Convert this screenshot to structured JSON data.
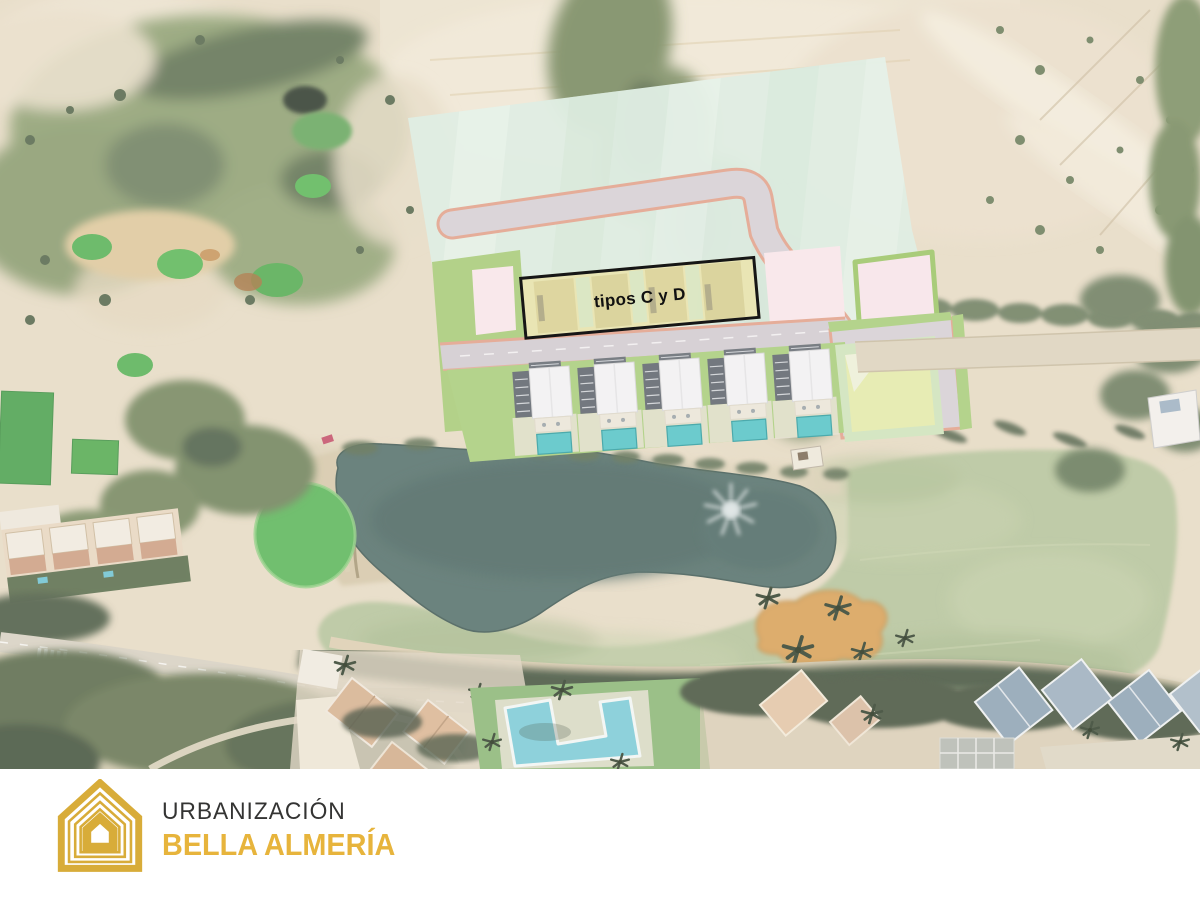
{
  "plan": {
    "plot_label": "tipos C y D"
  },
  "footer": {
    "brand_line1": "URBANIZACIÓN",
    "brand_line2": "BELLA ALMERÍA"
  },
  "legend_colors": {
    "development_overlay_green": "#DCEDE2",
    "plot_pink": "#F9E7EC",
    "plot_yellow_highlight": "#E8E3A9",
    "plot_border_green": "#9CC668",
    "road_edge_salmon": "#E2A28C",
    "villa_pool_teal": "#55C5C8",
    "lake_water": "#54716C",
    "golf_green": "#5BB75B",
    "fairway": "#B6C59D",
    "bunker_sand": "#D9A258",
    "brand_gold": "#D8AC39",
    "brand_text_dark": "#343433"
  }
}
